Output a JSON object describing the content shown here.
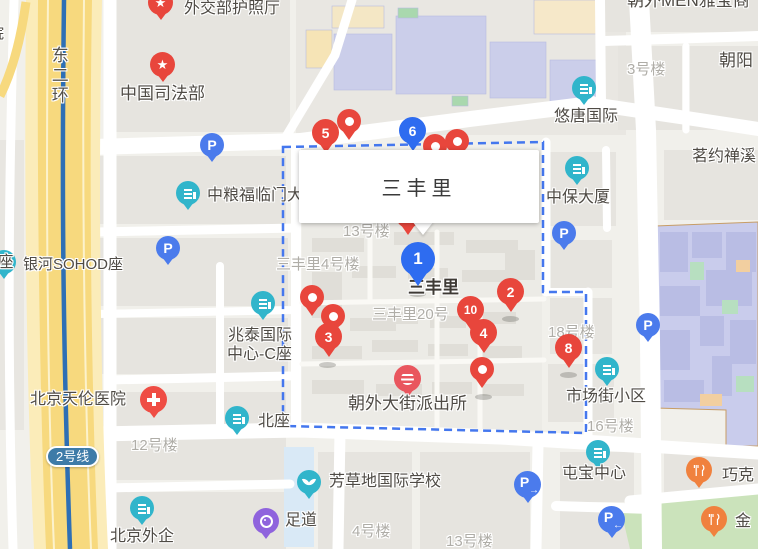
{
  "info_window": {
    "title": "三丰里"
  },
  "place_label": "三丰里",
  "numbered_markers": [
    {
      "n": "1",
      "color": "blue"
    },
    {
      "n": "2",
      "color": "red"
    },
    {
      "n": "3",
      "color": "red"
    },
    {
      "n": "4",
      "color": "red"
    },
    {
      "n": "5",
      "color": "red"
    },
    {
      "n": "6",
      "color": "blue"
    },
    {
      "n": "8",
      "color": "red"
    },
    {
      "n": "10",
      "color": "red"
    }
  ],
  "poi_labels": {
    "passport_hall": "外交部护照厅",
    "ministry_of_justice": "中国司法部",
    "chaowai_men_yabao": "朝外MEN雅宝商",
    "chaoyang": "朝阳",
    "youtang_intl": "悠唐国际",
    "mingyue_chanxi": "茗约禅溪",
    "zhongbao_tower": "中保大厦",
    "cofco_fulinmen": "中粮福临门大厦",
    "galaxy_soho_d": "银河SOHOD座",
    "c_block": "C座",
    "partial_left": "院",
    "zhaotai_line1": "兆泰国际",
    "zhaotai_line2": "中心-C座",
    "tianlun_hospital": "北京天伦医院",
    "north_block": "北座",
    "beijing_fesco": "北京外企",
    "foot_spa": "足道",
    "fangcaodi_school": "芳草地国际学校",
    "police_station": "朝外大街派出所",
    "market_street": "市场街小区",
    "tunbao_center": "屯宝中心",
    "qiaoke": "巧克",
    "jin": "金"
  },
  "building_labels": {
    "b3_top": "3号楼",
    "b13_upper": "13号楼",
    "sfl_b4": "三丰里4号楼",
    "sfl_20": "三丰里20号",
    "b18": "18号楼",
    "b16": "16号楼",
    "b12": "12号楼",
    "b4_bottom": "4号楼",
    "b13_bottom": "13号楼"
  },
  "road_labels": {
    "east_2nd_ring": "东二环",
    "line_2": "2号线"
  },
  "icons": {
    "star": "★",
    "parking": "P",
    "arrow_right": "→",
    "arrow_left": "←"
  },
  "colors": {
    "marker_red": "#E8463C",
    "marker_blue": "#2E6CF0",
    "poi_teal": "#31B5CB",
    "parking_blue": "#4B7BEC",
    "restaurant_orange": "#F0813E",
    "spa_purple": "#8F63DD",
    "boundary_blue": "#4477EE",
    "line2_badge": "#3E7BA8",
    "metro_line": "#2E6FB5",
    "hospital_red": "#EF4D44",
    "police_red": "#E9565E",
    "ring_road_yellow": "#F7D97E"
  }
}
